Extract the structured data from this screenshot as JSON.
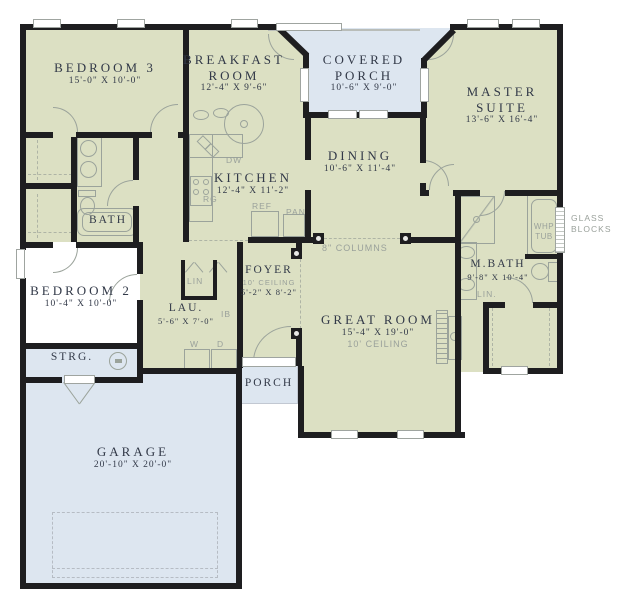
{
  "title": "single-story house floor plan",
  "colors": {
    "wall": "#1e1e20",
    "room_fill": "#dce0c3",
    "porch_garage_fill": "#dde6f0",
    "fixture_stroke": "#9ba39b",
    "text_dark": "#323948",
    "text_grey": "#9aa19b"
  },
  "rooms": {
    "bedroom3": {
      "name": "BEDROOM 3",
      "dims": "15'-0\" X 10'-0\""
    },
    "breakfast": {
      "l1": "BREAKFAST",
      "l2": "ROOM",
      "dims": "12'-4\" X 9'-6\""
    },
    "covered_porch": {
      "l1": "COVERED",
      "l2": "PORCH",
      "dims": "10'-6\" X 9'-0\""
    },
    "master": {
      "l1": "MASTER",
      "l2": "SUITE",
      "dims": "13'-6\" X 16'-4\""
    },
    "kitchen": {
      "name": "KITCHEN",
      "dims": "12'-4\" X 11'-2\""
    },
    "dining": {
      "name": "DINING",
      "dims": "10'-6\" X 11'-4\""
    },
    "bath": {
      "name": "BATH"
    },
    "bedroom2": {
      "name": "BEDROOM 2",
      "dims": "10'-4\" X 10'-0\""
    },
    "foyer": {
      "name": "FOYER",
      "ceiling": "10' CEILING",
      "dims": "5'-2\" X 8'-2\""
    },
    "lau": {
      "name": "LAU.",
      "dims": "5'-6\" X 7'-0\""
    },
    "great": {
      "name": "GREAT ROOM",
      "dims": "15'-4\" X 19'-0\"",
      "ceiling": "10' CEILING"
    },
    "mbath": {
      "name": "M.BATH",
      "dims": "9'-8\" X 10'-4\""
    },
    "strg": {
      "name": "STRG."
    },
    "garage": {
      "name": "GARAGE",
      "dims": "20'-10\" X 20'-0\""
    },
    "porch": {
      "name": "PORCH"
    }
  },
  "annotations": {
    "columns": "8\" COLUMNS",
    "glass_l1": "GLASS",
    "glass_l2": "BLOCKS",
    "whp_l1": "WHP",
    "whp_l2": "TUB",
    "dw": "DW",
    "rg": "RG",
    "ref": "REF",
    "pan": "PAN",
    "lin": "LIN",
    "lin2": "LIN.",
    "w": "W",
    "d": "D",
    "ib": "IB"
  }
}
